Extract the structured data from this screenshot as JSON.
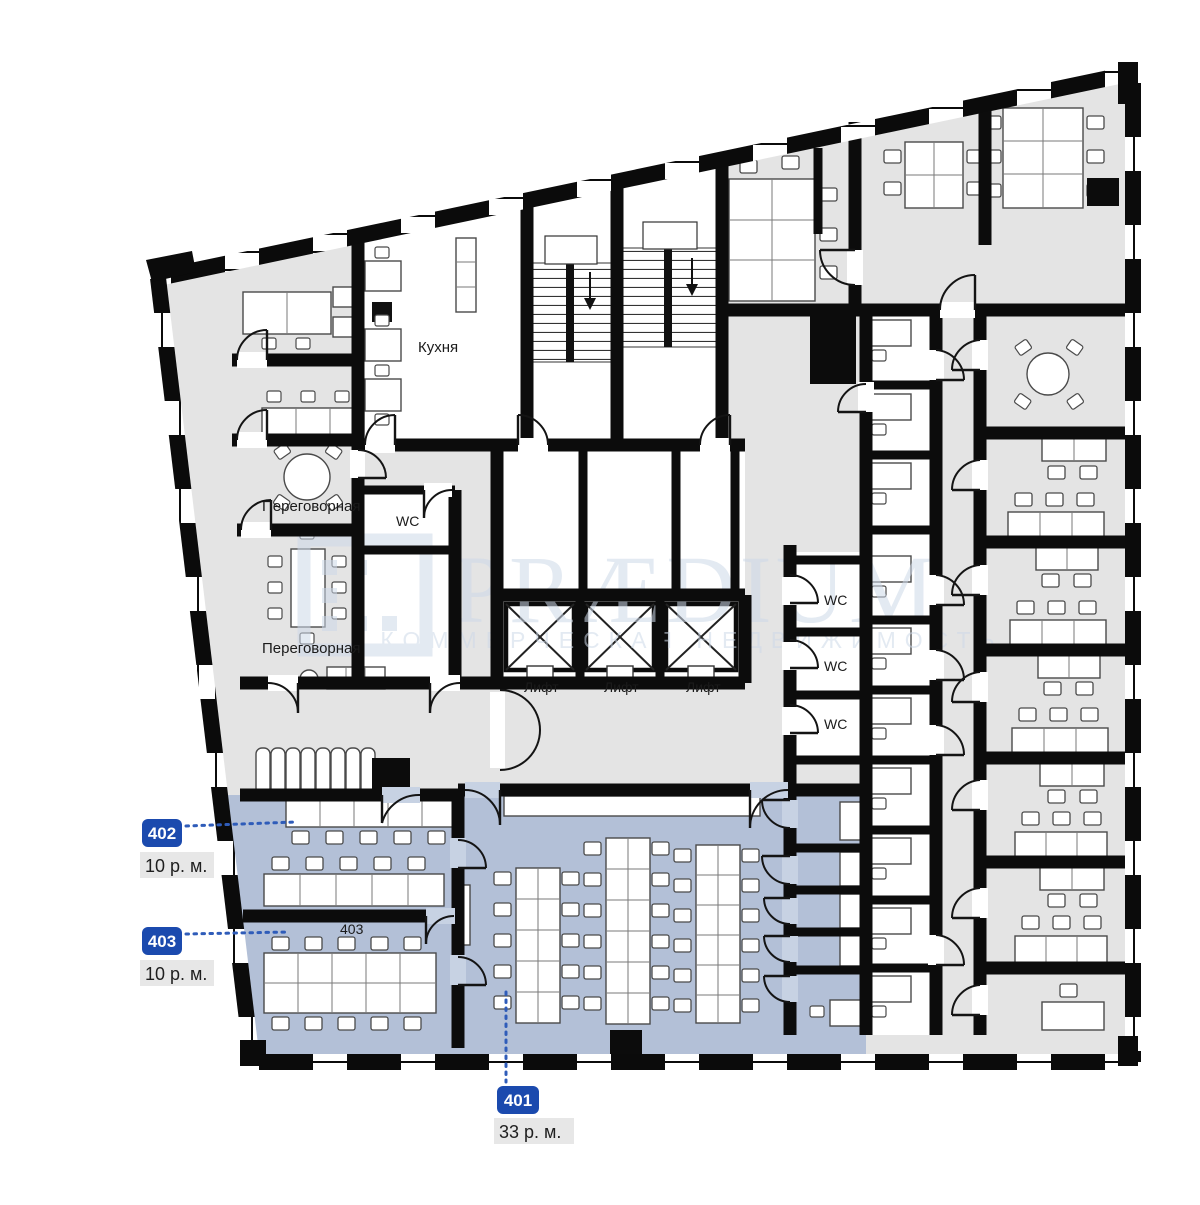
{
  "plan": {
    "labels": {
      "kitchen": "Кухня",
      "meeting_room": "Переговорная",
      "wc": "WC",
      "elevator": "Лифт"
    },
    "units": {
      "u401": {
        "number": "401",
        "area": "33 р. м."
      },
      "u402": {
        "number": "402",
        "area": "10 р. м."
      },
      "u403": {
        "number": "403",
        "area": "10 р. м."
      }
    },
    "watermark": {
      "name": "PRÆDIUM",
      "tagline": "КОММЕРЧЕСКАЯ НЕДВИЖИМОСТЬ"
    },
    "colors": {
      "highlight": "#b3c0d7",
      "badge": "#1b4aae",
      "leader": "#2f5cb9",
      "floor": "#e4e4e4",
      "watermark": "#cdd9e8"
    }
  }
}
